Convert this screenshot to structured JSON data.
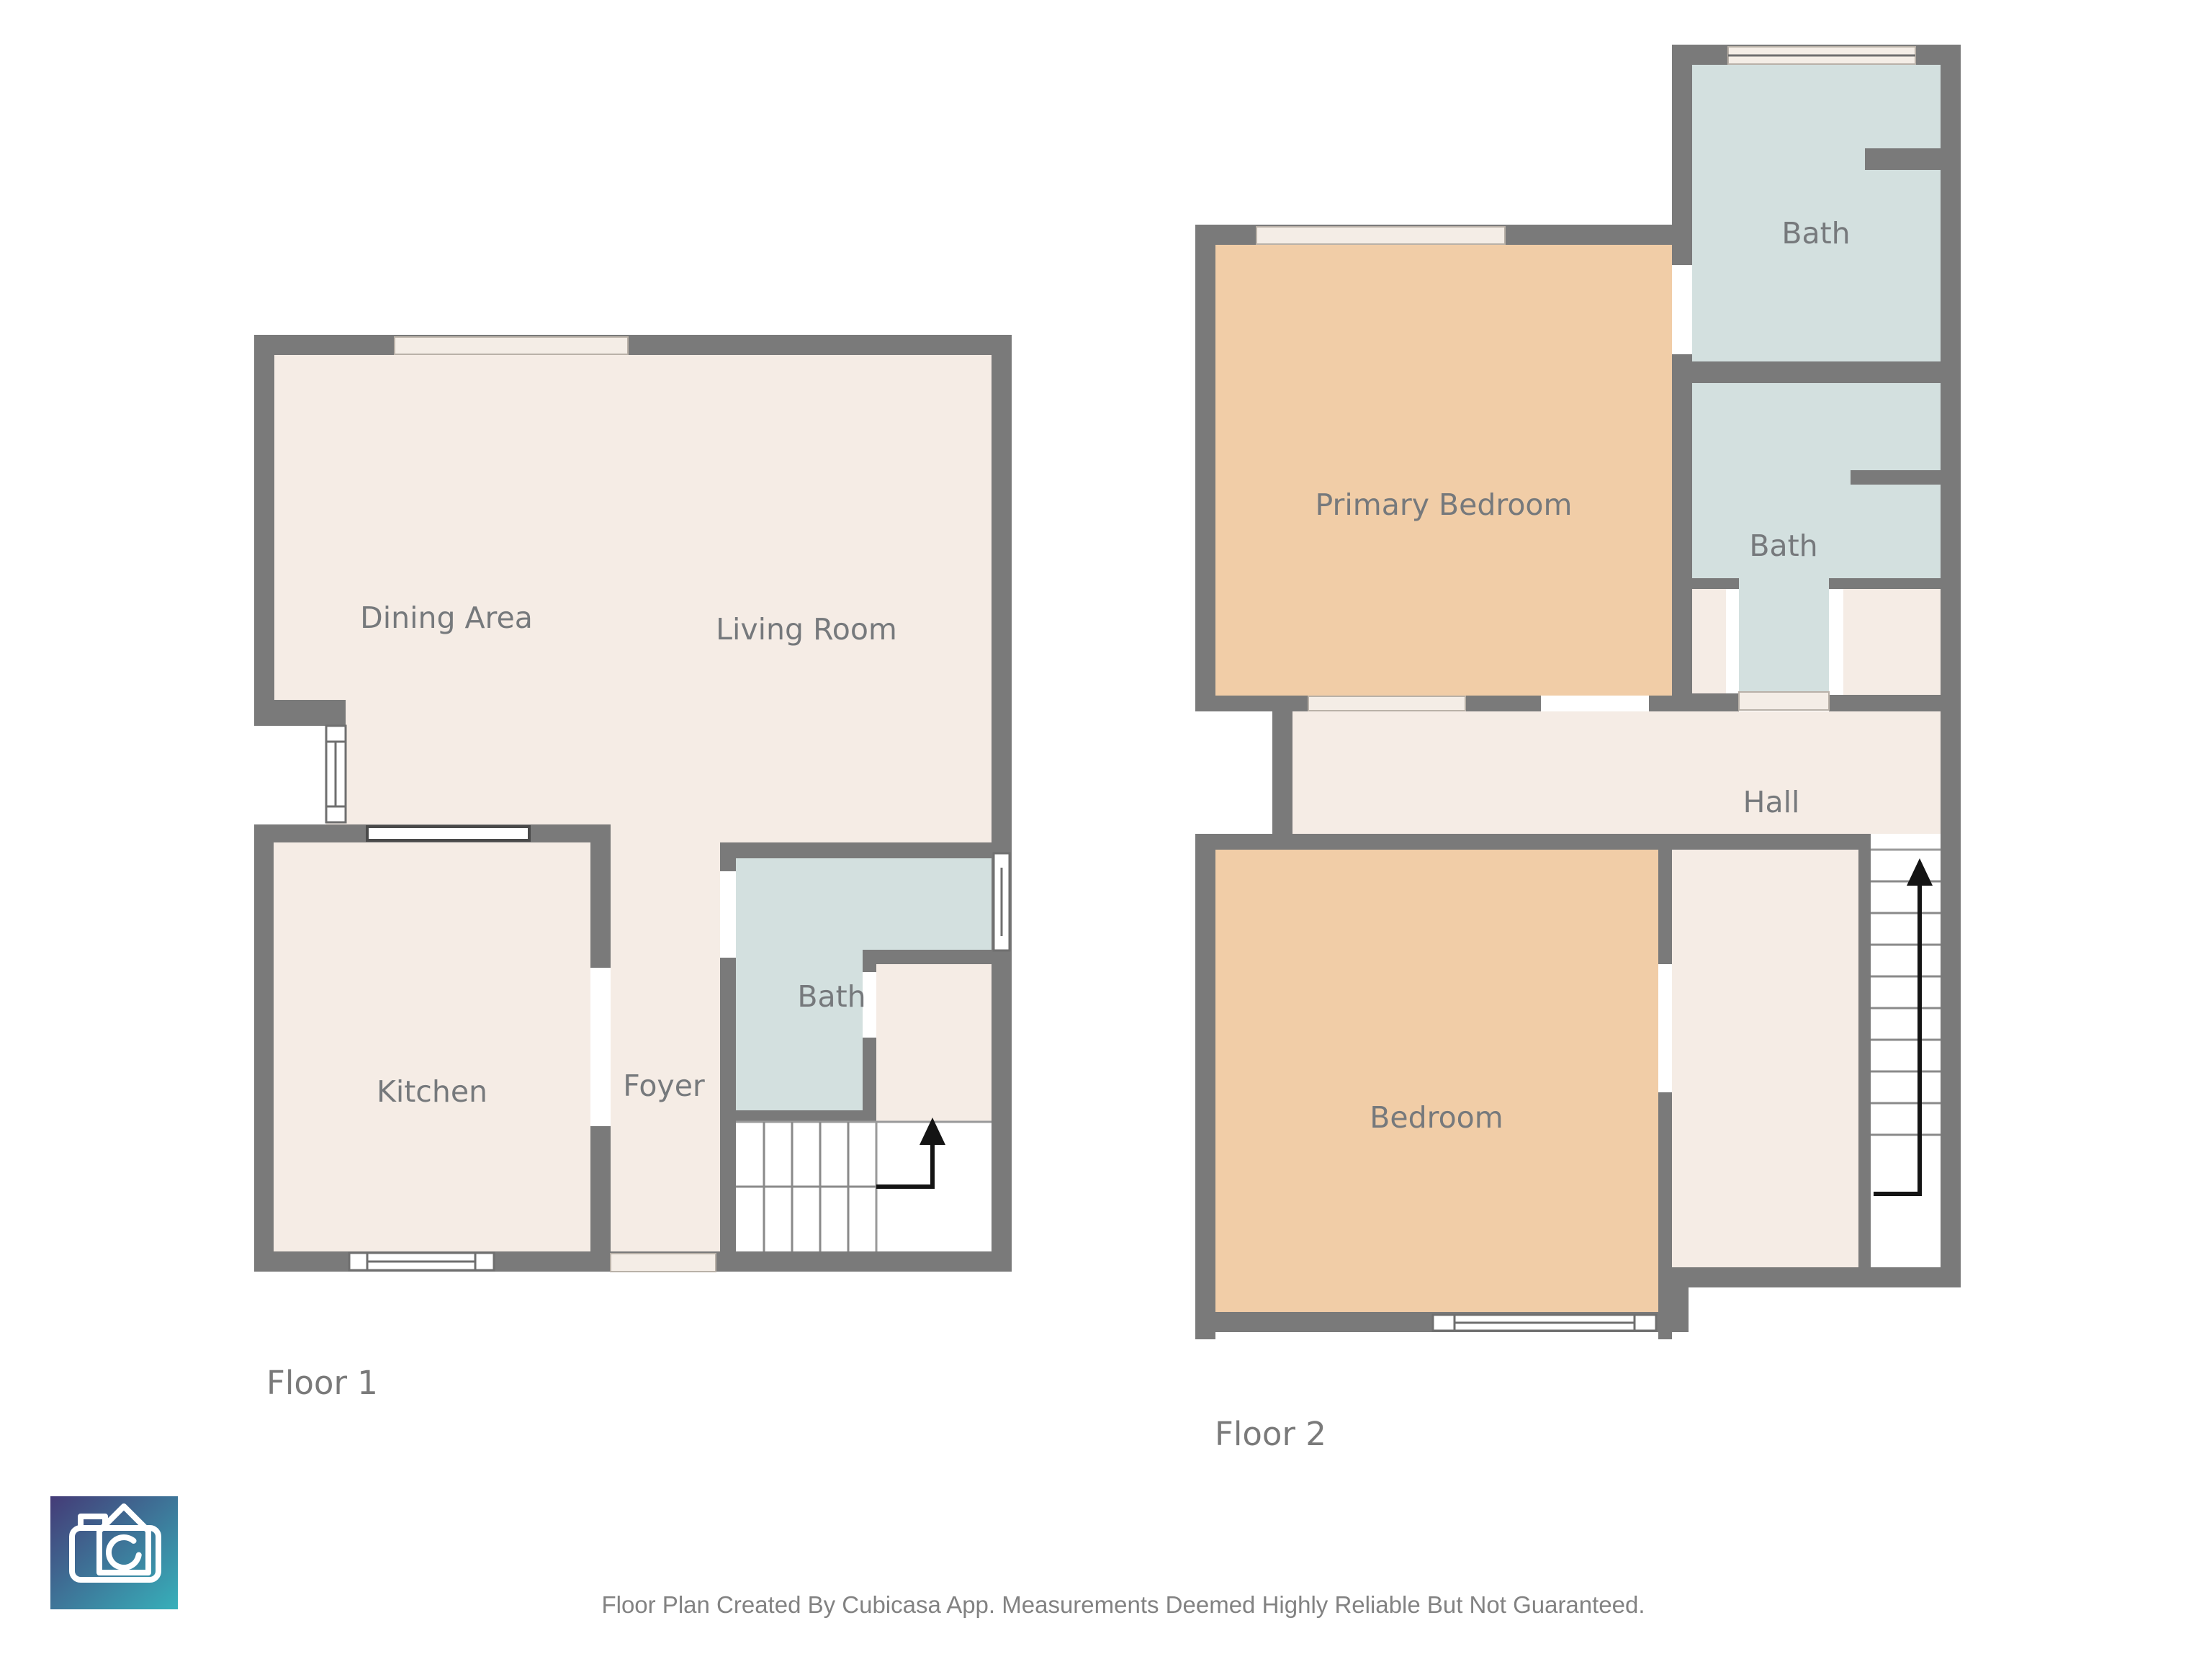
{
  "floors": {
    "floor1": {
      "title": "Floor 1",
      "rooms": {
        "dining": "Dining Area",
        "living": "Living Room",
        "kitchen": "Kitchen",
        "foyer": "Foyer",
        "bath": "Bath"
      }
    },
    "floor2": {
      "title": "Floor 2",
      "rooms": {
        "primary": "Primary Bedroom",
        "bath_upper": "Bath",
        "bath_lower": "Bath",
        "hall": "Hall",
        "bedroom": "Bedroom"
      }
    }
  },
  "footer": {
    "disclaimer": "Floor Plan Created By Cubicasa App. Measurements Deemed Highly Reliable But Not Guaranteed."
  },
  "logo": {
    "name": "cubicasa-camera-logo"
  },
  "colors": {
    "wall": "#7a7a7a",
    "floor": "#f5ece5",
    "bedroom": "#f1cda7",
    "bath": "#d3e0df",
    "door_slab": "#f4ede6",
    "window": "#ffffff",
    "room_label_text": "#76797c",
    "floor_title_text": "#7a7a7a",
    "footer_text": "#828282",
    "stair_arrow": "#141414",
    "logo_gradient_start": "#443b77",
    "logo_gradient_end": "#37b0ba"
  }
}
